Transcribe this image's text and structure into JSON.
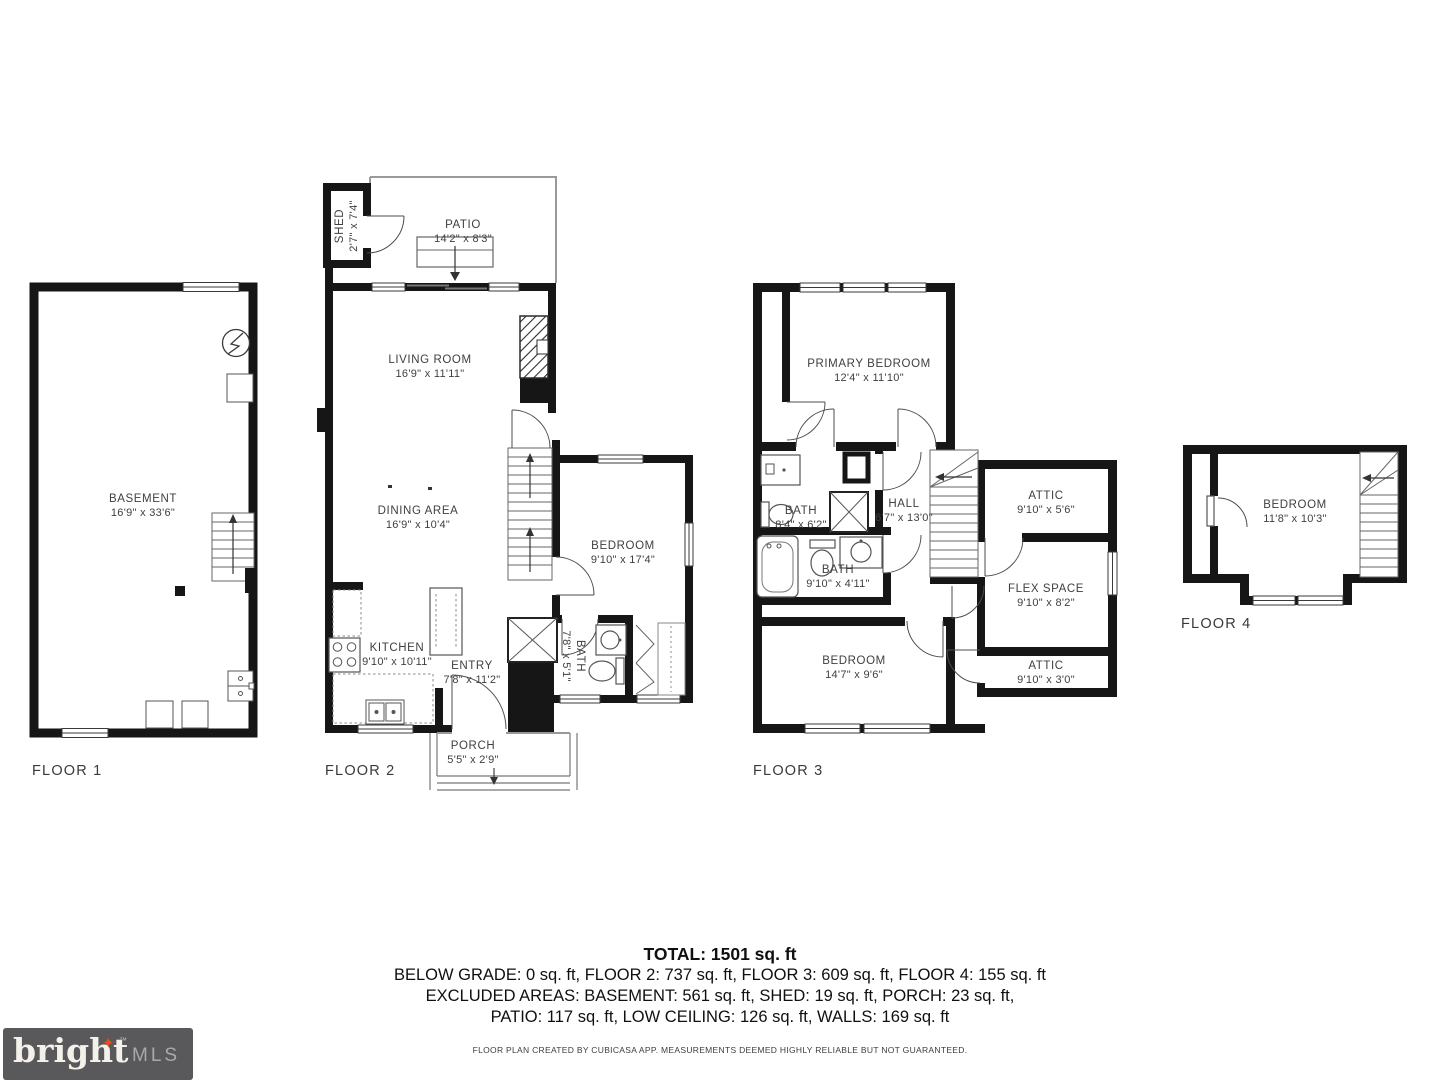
{
  "floors": [
    {
      "id": "floor-1",
      "label": "FLOOR 1",
      "label_pos": {
        "x": 32,
        "y": 763
      },
      "rooms": [
        {
          "id": "basement",
          "name": "BASEMENT",
          "dims": "16'9\" x 33'6\"",
          "x": 143,
          "y": 506
        }
      ]
    },
    {
      "id": "floor-2",
      "label": "FLOOR 2",
      "label_pos": {
        "x": 325,
        "y": 763
      },
      "rooms": [
        {
          "id": "shed",
          "name": "SHED",
          "dims": "2'7\" x 7'4\"",
          "x": 347,
          "y": 226,
          "rotate": -90
        },
        {
          "id": "patio",
          "name": "PATIO",
          "dims": "14'2\" x 8'3\"",
          "x": 463,
          "y": 232
        },
        {
          "id": "living-room",
          "name": "LIVING ROOM",
          "dims": "16'9\" x 11'11\"",
          "x": 430,
          "y": 367
        },
        {
          "id": "dining-area",
          "name": "DINING AREA",
          "dims": "16'9\" x 10'4\"",
          "x": 418,
          "y": 518
        },
        {
          "id": "bedroom-2",
          "name": "BEDROOM",
          "dims": "9'10\" x 17'4\"",
          "x": 623,
          "y": 553
        },
        {
          "id": "kitchen",
          "name": "KITCHEN",
          "dims": "9'10\" x 10'11\"",
          "x": 397,
          "y": 655
        },
        {
          "id": "entry",
          "name": "ENTRY",
          "dims": "7'8\" x 11'2\"",
          "x": 472,
          "y": 673
        },
        {
          "id": "bath-2",
          "name": "BATH",
          "dims": "7'8\" x 5'1\"",
          "x": 573,
          "y": 656,
          "rotate": 90
        },
        {
          "id": "porch",
          "name": "PORCH",
          "dims": "5'5\" x 2'9\"",
          "x": 473,
          "y": 753
        }
      ]
    },
    {
      "id": "floor-3",
      "label": "FLOOR 3",
      "label_pos": {
        "x": 753,
        "y": 763
      },
      "rooms": [
        {
          "id": "primary-bedroom",
          "name": "PRIMARY BEDROOM",
          "dims": "12'4\" x 11'10\"",
          "x": 869,
          "y": 371
        },
        {
          "id": "bath-upper",
          "name": "BATH",
          "dims": "8'4\" x 6'2\"",
          "x": 801,
          "y": 518
        },
        {
          "id": "hall",
          "name": "HALL",
          "dims": "6'7\" x 13'0\"",
          "x": 904,
          "y": 511
        },
        {
          "id": "attic-upper",
          "name": "ATTIC",
          "dims": "9'10\" x 5'6\"",
          "x": 1046,
          "y": 503
        },
        {
          "id": "bath-lower",
          "name": "BATH",
          "dims": "9'10\" x 4'11\"",
          "x": 838,
          "y": 577
        },
        {
          "id": "flex-space",
          "name": "FLEX SPACE",
          "dims": "9'10\" x 8'2\"",
          "x": 1046,
          "y": 596
        },
        {
          "id": "bedroom-3",
          "name": "BEDROOM",
          "dims": "14'7\" x 9'6\"",
          "x": 854,
          "y": 668
        },
        {
          "id": "attic-lower",
          "name": "ATTIC",
          "dims": "9'10\" x 3'0\"",
          "x": 1046,
          "y": 673
        }
      ]
    },
    {
      "id": "floor-4",
      "label": "FLOOR 4",
      "label_pos": {
        "x": 1181,
        "y": 616
      },
      "rooms": [
        {
          "id": "bedroom-4",
          "name": "BEDROOM",
          "dims": "11'8\" x 10'3\"",
          "x": 1295,
          "y": 512
        }
      ]
    }
  ],
  "summary": {
    "total": "TOTAL: 1501 sq. ft",
    "lines": [
      "BELOW GRADE: 0 sq. ft, FLOOR 2: 737 sq. ft, FLOOR 3: 609 sq. ft, FLOOR 4: 155 sq. ft",
      "EXCLUDED AREAS: BASEMENT: 561 sq. ft, SHED: 19 sq. ft, PORCH: 23 sq. ft,",
      "PATIO: 117 sq. ft, LOW CEILING: 126 sq. ft, WALLS: 169 sq. ft"
    ]
  },
  "disclaimer": "FLOOR PLAN CREATED BY CUBICASA APP. MEASUREMENTS DEEMED HIGHLY RELIABLE BUT NOT GUARANTEED.",
  "logo": {
    "brand": "bright",
    "suffix": "MLS",
    "tm": "™",
    "colors": {
      "background": "#59595b",
      "brand": "#f4f1ea",
      "suffix": "#a9a9ac",
      "sparkle": "#e8500f"
    }
  },
  "plan_colors": {
    "wall": "#161616",
    "fixture": "#555555",
    "thin_outline": "#9a9a9a"
  }
}
